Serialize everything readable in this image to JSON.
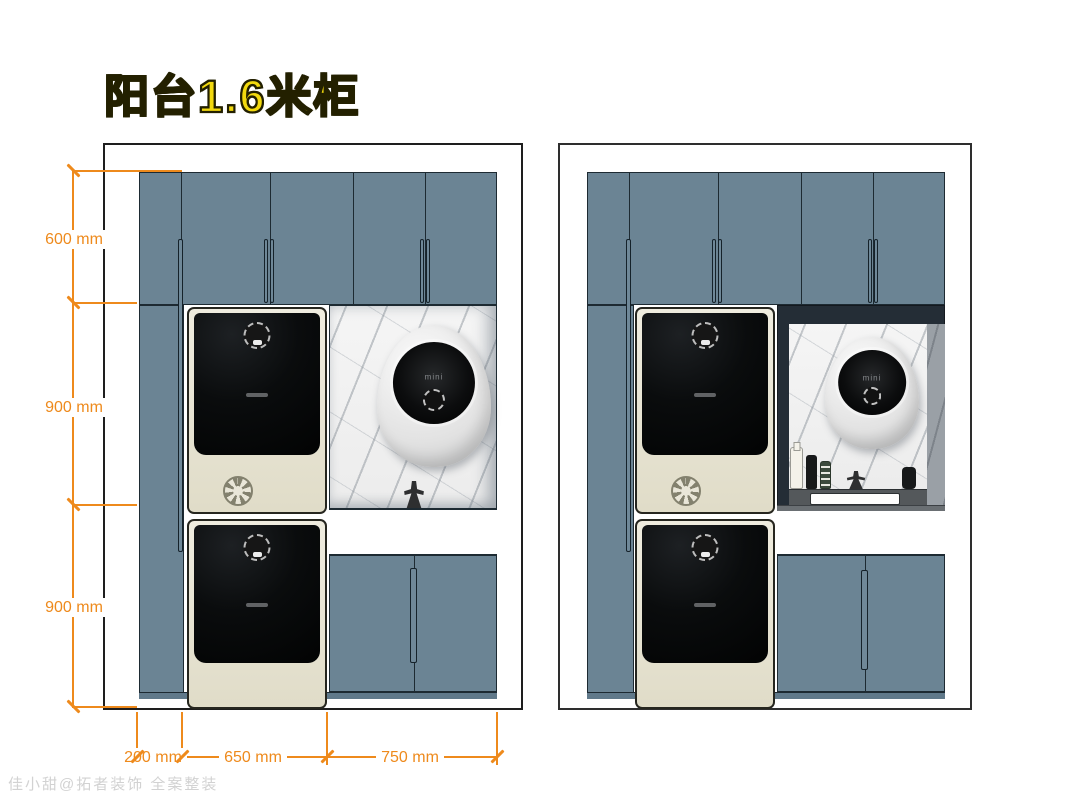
{
  "title": "阳台1.6米柜",
  "watermark": "佳小甜@拓者装饰 全案整装",
  "colors": {
    "cabinet_blue": "#6b8494",
    "dimension_orange": "#ee8a1c",
    "title_yellow": "#f2d90e",
    "washer_cream": "#eae7d9",
    "niche_navy": "#242d36",
    "marble_white": "#f5f5f5"
  },
  "appliances": {
    "dryer_label": "mini"
  },
  "left_view": {
    "vertical_dims": [
      {
        "label": "600 mm"
      },
      {
        "label": "900 mm"
      },
      {
        "label": "900 mm"
      }
    ],
    "horizontal_dims": [
      {
        "label": "200 mm"
      },
      {
        "label": "650 mm"
      },
      {
        "label": "750 mm"
      }
    ]
  }
}
